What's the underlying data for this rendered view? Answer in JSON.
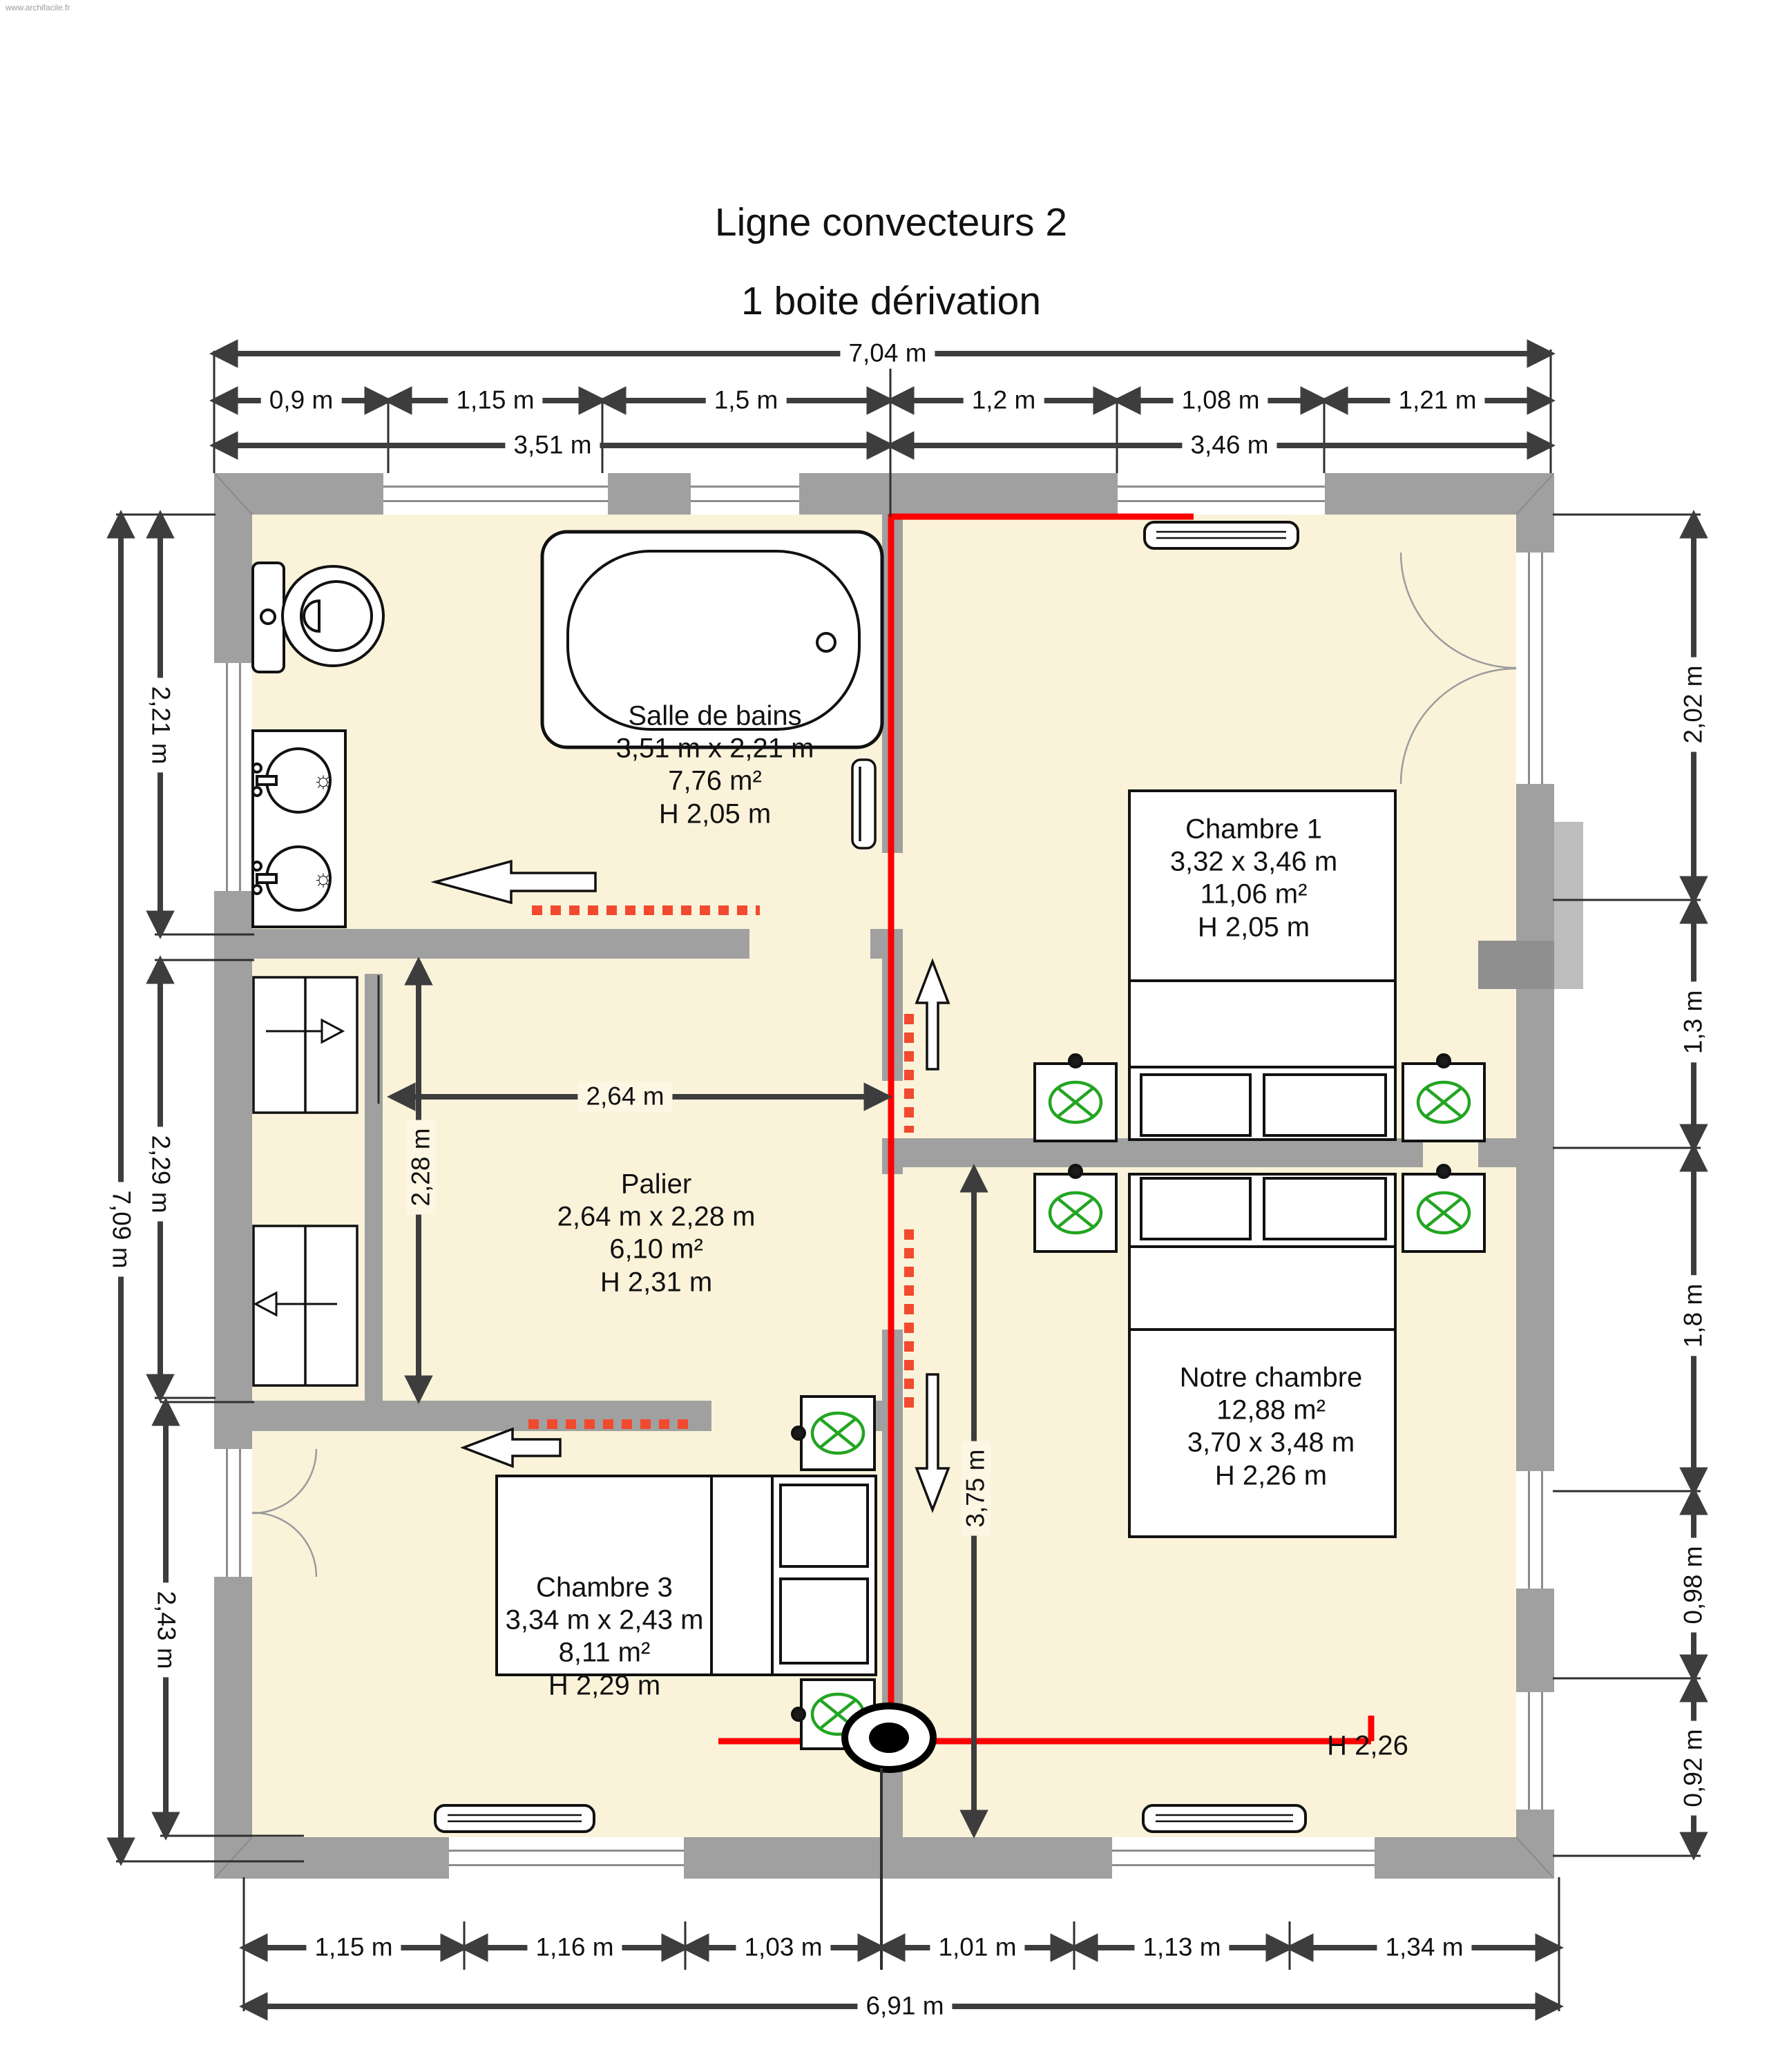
{
  "watermark": "www.archifacile.fr",
  "title": {
    "line1": "Ligne convecteurs 2",
    "line2": "1 boite dérivation"
  },
  "rooms": {
    "salle_de_bains": {
      "name": "Salle de bains",
      "dimensions": "3,51 m x 2,21 m",
      "area": "7,76 m²",
      "height": "H 2,05 m"
    },
    "chambre1": {
      "name": "Chambre 1",
      "dimensions": "3,32 x 3,46 m",
      "area": "11,06 m²",
      "height": "H 2,05 m"
    },
    "palier": {
      "name": "Palier",
      "dimensions": "2,64 m x 2,28 m",
      "area": "6,10 m²",
      "height": "H 2,31 m"
    },
    "notre_chambre": {
      "name": "Notre chambre",
      "area": "12,88 m²",
      "dimensions": "3,70 x 3,48 m",
      "height": "H 2,26 m"
    },
    "chambre3": {
      "name": "Chambre 3",
      "dimensions": "3,34 m x 2,43 m",
      "area": "8,11 m²",
      "height": "H 2,29 m"
    },
    "annotation_h226": "H 2,26"
  },
  "dimensions": {
    "top_total": "7,04 m",
    "top_segments": [
      "0,9 m",
      "1,15 m",
      "1,5 m",
      "1,2 m",
      "1,08 m",
      "1,21 m"
    ],
    "top_halves": [
      "3,51 m",
      "3,46 m"
    ],
    "left_segments": [
      "2,21 m",
      "2,29 m",
      "2,43 m"
    ],
    "left_total": "7,09 m",
    "right_segments": [
      "2,02 m",
      "1,3 m",
      "1,8 m",
      "0,98 m",
      "0,92 m"
    ],
    "bottom_segments": [
      "1,15 m",
      "1,16 m",
      "1,03 m",
      "1,01 m",
      "1,13 m",
      "1,34 m"
    ],
    "bottom_total": "6,91 m",
    "palier_width": "2,64 m",
    "palier_height": "2,28 m",
    "notre_chambre_height": "3,75 m"
  },
  "colors": {
    "floor": "#faf3da",
    "wall": "#a0a0a0",
    "convector_line": "#fd0000",
    "convector_dash": "#f14a2e",
    "lamp_symbol": "#22a522",
    "dimension": "#3d3d3d"
  }
}
